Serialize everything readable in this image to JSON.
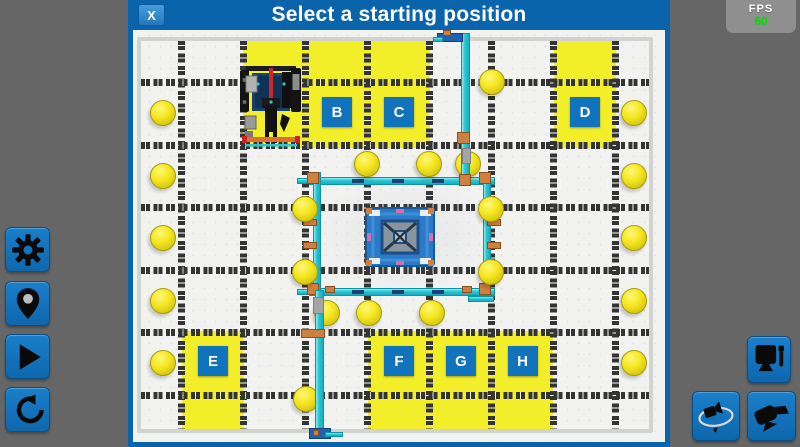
{
  "dialog": {
    "title": "Select a starting position",
    "close_label": "X"
  },
  "fps_panel": {
    "label": "FPS",
    "value": "60"
  },
  "colors": {
    "dialog_blue": "#0a64ab",
    "button_blue": "#1273bd",
    "tile_yellow": "#f3ee2a",
    "teal": "#2cc6d4",
    "orange": "#cd8040",
    "fps_green": "#00dd00",
    "background_gray": "#666666"
  },
  "sidebar": {
    "buttons": [
      {
        "id": "settings",
        "icon": "gear-icon"
      },
      {
        "id": "starting-position",
        "icon": "pin-icon"
      },
      {
        "id": "play",
        "icon": "play-icon"
      },
      {
        "id": "reset",
        "icon": "reset-icon"
      }
    ]
  },
  "camera_controls": {
    "buttons": [
      {
        "id": "robot-view",
        "icon": "monitor-icon"
      },
      {
        "id": "orbit-camera",
        "icon": "orbit-camera-icon"
      },
      {
        "id": "side-camera",
        "icon": "video-camera-icon"
      }
    ]
  },
  "scene": {
    "field": {
      "outer": [
        137,
        37,
        516,
        396
      ],
      "v_lines": [
        181,
        243,
        305,
        367,
        429,
        491,
        553,
        615
      ],
      "h_lines": [
        82,
        145,
        207,
        270,
        332,
        395
      ],
      "line_thickness": 7,
      "line_top": 41,
      "line_bottom": 429,
      "line_left": 141,
      "line_right": 649
    },
    "start_tiles": [
      {
        "label": "",
        "rect": [
          243,
          41,
          63,
          107
        ],
        "robot": true
      },
      {
        "label": "B",
        "rect": [
          306,
          41,
          62,
          107
        ]
      },
      {
        "label": "C",
        "rect": [
          368,
          41,
          62,
          107
        ]
      },
      {
        "label": "D",
        "rect": [
          554,
          41,
          62,
          107
        ]
      },
      {
        "label": "E",
        "rect": [
          182,
          331,
          62,
          99
        ]
      },
      {
        "label": "F",
        "rect": [
          368,
          331,
          62,
          99
        ]
      },
      {
        "label": "G",
        "rect": [
          430,
          331,
          62,
          99
        ]
      },
      {
        "label": "H",
        "rect": [
          492,
          331,
          61,
          99
        ]
      }
    ],
    "label_row_y": {
      "top": 112,
      "bottom": 361
    },
    "ball_diameter": 26,
    "balls": [
      [
        163,
        113
      ],
      [
        163,
        176
      ],
      [
        163,
        238
      ],
      [
        163,
        301
      ],
      [
        163,
        363
      ],
      [
        634,
        113
      ],
      [
        634,
        176
      ],
      [
        634,
        238
      ],
      [
        634,
        301
      ],
      [
        634,
        363
      ],
      [
        492,
        82
      ],
      [
        367,
        164
      ],
      [
        429,
        164
      ],
      [
        468,
        164
      ],
      [
        305,
        209
      ],
      [
        491,
        209
      ],
      [
        305,
        272
      ],
      [
        491,
        272
      ],
      [
        327,
        313
      ],
      [
        369,
        313
      ],
      [
        432,
        313
      ],
      [
        306,
        399
      ]
    ],
    "structure": {
      "haze": [
        314,
        178,
        178,
        116
      ],
      "teal_beams": [
        [
          309,
          177,
          186,
          8
        ],
        [
          309,
          288,
          186,
          8
        ],
        [
          297,
          178,
          14,
          6
        ],
        [
          297,
          289,
          14,
          6
        ],
        [
          468,
          296,
          26,
          6
        ]
      ],
      "teal_vbeams": [
        [
          313,
          172,
          8,
          124
        ],
        [
          483,
          172,
          8,
          124
        ]
      ],
      "poles": [
        [
          461,
          33,
          9,
          153
        ],
        [
          315,
          290,
          9,
          148
        ]
      ],
      "orange_blocks": [
        [
          307,
          172,
          12,
          12
        ],
        [
          479,
          172,
          12,
          12
        ],
        [
          307,
          283,
          12,
          12
        ],
        [
          479,
          283,
          12,
          12
        ],
        [
          303,
          219,
          14,
          7
        ],
        [
          303,
          242,
          14,
          7
        ],
        [
          487,
          219,
          14,
          7
        ],
        [
          487,
          242,
          14,
          7
        ],
        [
          325,
          286,
          10,
          7
        ],
        [
          462,
          286,
          10,
          7
        ]
      ],
      "pole_orange": [
        [
          457,
          132,
          13,
          12
        ],
        [
          459,
          174,
          12,
          12
        ],
        [
          301,
          329,
          24,
          9
        ],
        [
          313,
          430,
          6,
          6
        ],
        [
          443,
          30,
          8,
          6
        ]
      ],
      "navy_dashes": [
        [
          352,
          179,
          12,
          4
        ],
        [
          392,
          179,
          12,
          4
        ],
        [
          432,
          179,
          12,
          4
        ],
        [
          352,
          290,
          12,
          4
        ],
        [
          392,
          290,
          12,
          4
        ],
        [
          432,
          290,
          12,
          4
        ]
      ],
      "gray_bits": [
        [
          313,
          297,
          11,
          17
        ],
        [
          462,
          148,
          9,
          16
        ]
      ],
      "blue_bits": [
        [
          437,
          33,
          26,
          9
        ],
        [
          309,
          428,
          22,
          11
        ]
      ],
      "teal_bits": [
        [
          433,
          37,
          10,
          5
        ],
        [
          325,
          432,
          18,
          5
        ]
      ],
      "inner_square": [
        365,
        207,
        70,
        60
      ]
    },
    "robot": {
      "rect": [
        238,
        64,
        66,
        84
      ]
    }
  }
}
